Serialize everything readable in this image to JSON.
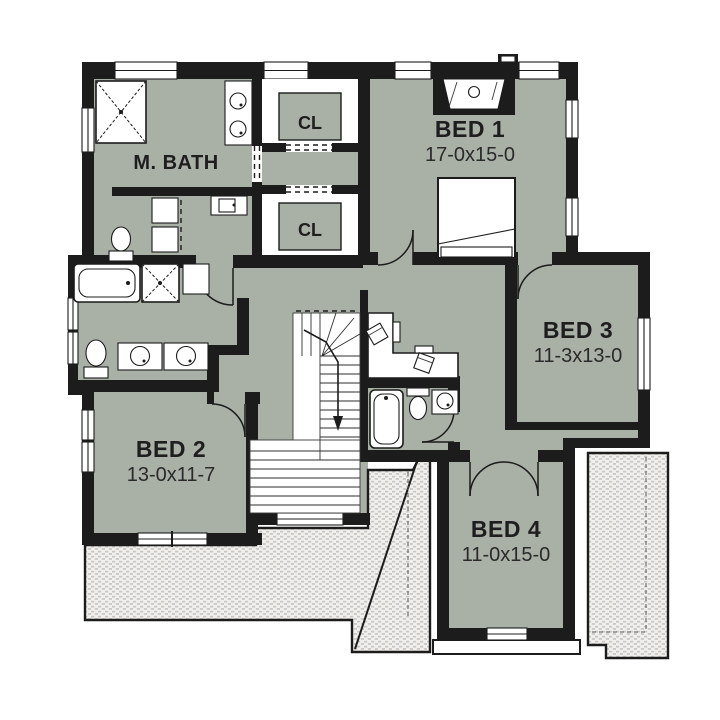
{
  "plan": {
    "type": "second-floor house plan",
    "colors": {
      "floor": "#a9b1a6",
      "wall": "#1c1c1c",
      "background": "#ffffff",
      "roof_hatch": "#d9d7d3"
    },
    "rooms": {
      "bed1": {
        "name": "BED 1",
        "dims": "17-0x15-0"
      },
      "bed2": {
        "name": "BED 2",
        "dims": "13-0x11-7"
      },
      "bed3": {
        "name": "BED 3",
        "dims": "11-3x13-0"
      },
      "bed4": {
        "name": "BED 4",
        "dims": "11-0x15-0"
      },
      "master_bath": {
        "name": "M. BATH"
      },
      "closet1": {
        "name": "CL"
      },
      "closet2": {
        "name": "CL"
      }
    }
  }
}
